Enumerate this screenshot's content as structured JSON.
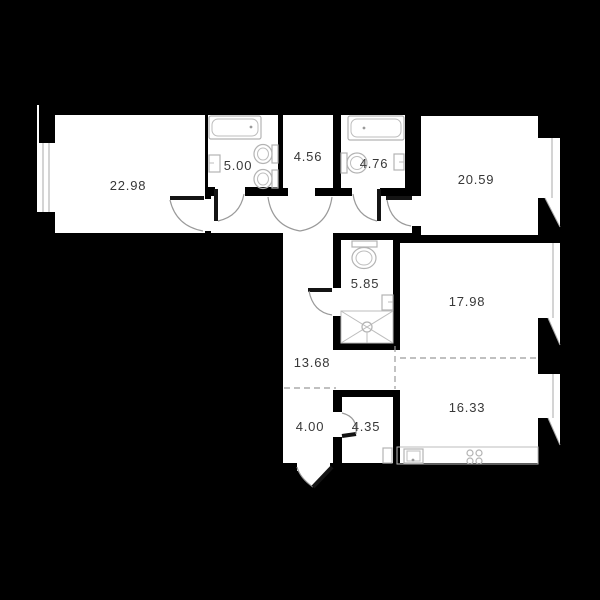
{
  "plan": {
    "title": "apartment-floor-plan",
    "units": "square-meters",
    "colors": {
      "background": "#000000",
      "room_fill": "#ffffff",
      "fixture_stroke": "#b3b3b3",
      "door_arc": "#9a9a9a",
      "door_leaf": "#141414",
      "dashed_divider": "#9b9b9b",
      "label_text": "#383838"
    },
    "rooms": [
      {
        "name": "living-room-left",
        "area": "22.98"
      },
      {
        "name": "bathroom-1",
        "area": "5.00"
      },
      {
        "name": "wardrobe",
        "area": "4.56"
      },
      {
        "name": "bathroom-2",
        "area": "4.76"
      },
      {
        "name": "bedroom-right",
        "area": "20.59"
      },
      {
        "name": "shower-room",
        "area": "5.85"
      },
      {
        "name": "room-right-middle",
        "area": "17.98"
      },
      {
        "name": "hallway",
        "area": "13.68"
      },
      {
        "name": "entry-vestibule",
        "area": "4.00"
      },
      {
        "name": "storage",
        "area": "4.35"
      },
      {
        "name": "kitchen-living",
        "area": "16.33"
      }
    ],
    "fixtures": [
      "bathtub-1",
      "sink-1",
      "toilet-1",
      "toilet-2",
      "bathtub-2",
      "toilet-3",
      "sink-2",
      "toilet-4",
      "sink-3",
      "shower-tray",
      "kitchen-counter",
      "kitchen-sink",
      "stove-4-burners",
      "washer"
    ],
    "windows": [
      "window-left",
      "window-right-top",
      "window-right-middle",
      "window-right-bottom"
    ],
    "doors": [
      "door-living-room",
      "door-bathroom-1",
      "door-wardrobe",
      "door-bathroom-2",
      "door-bedroom",
      "door-shower-room",
      "door-storage",
      "entrance-door"
    ]
  }
}
